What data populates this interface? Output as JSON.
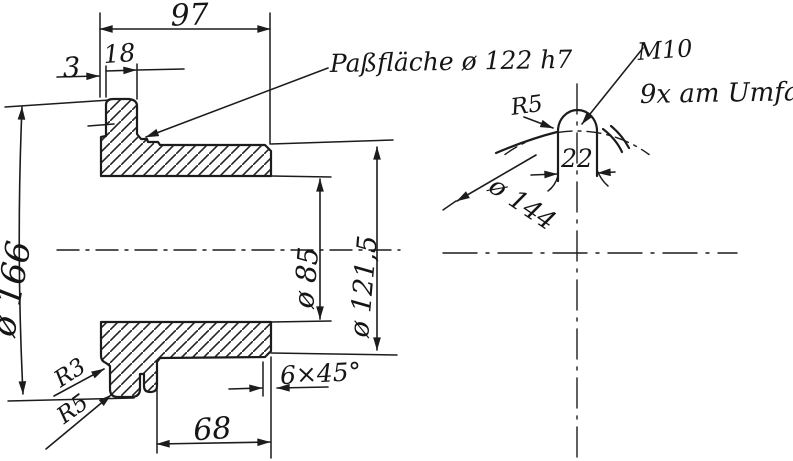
{
  "drawing": {
    "colors": {
      "ink": "#1c1c1c",
      "paper": "#ffffff"
    },
    "main_view": {
      "dim_total_length": "97",
      "dim_face_offset": "3",
      "dim_rim_width": "18",
      "note_fit_surface": "Paßfläche ø 122 h7",
      "dim_outer_diameter": "ø 166",
      "dim_bore_diameter": "ø 85",
      "dim_barrel_diameter": "ø 121,5",
      "dim_barrel_length": "68",
      "dim_chamfer": "6×45°",
      "dim_fillet_upper": "R3",
      "dim_fillet_lower": "R5"
    },
    "detail_view": {
      "dim_lug_fillet": "R5",
      "note_thread": "M10",
      "note_count": "9x am Umfang",
      "dim_lug_width": "22",
      "dim_bolt_circle": "ø 144"
    }
  }
}
